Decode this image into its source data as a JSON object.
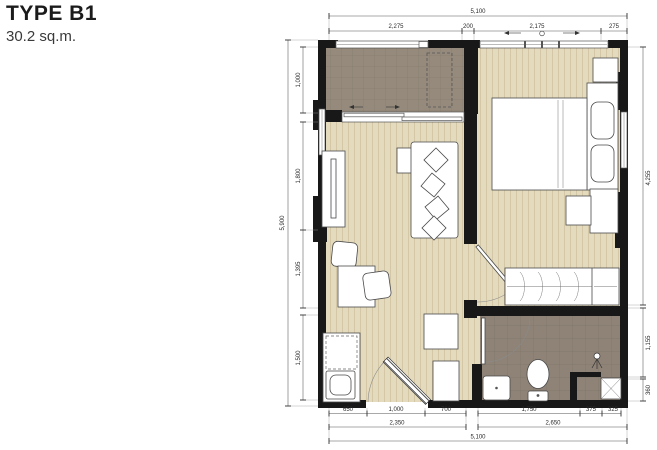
{
  "header": {
    "title": "TYPE B1",
    "area": "30.2 sq.m."
  },
  "dimensions": {
    "top": {
      "overall": "5,100",
      "segments": [
        "2,275",
        "200",
        "2,175",
        "275"
      ]
    },
    "left": {
      "overall": "5,900",
      "segments": [
        "1,000",
        "1,800",
        "1,395",
        "1,500"
      ]
    },
    "right": {
      "segments": [
        "4,255",
        "1,155",
        "360"
      ]
    },
    "bottom": {
      "segments": [
        "650",
        "1,000",
        "700",
        "1,750",
        "375",
        "325"
      ],
      "subtotals": [
        "2,350",
        "2,650"
      ],
      "overall": "5,100"
    }
  },
  "colors": {
    "wall": "#181818",
    "wood_floor": "#e4dabd",
    "wood_stripe": "#d3c7a6",
    "balcony_floor": "#958a7c",
    "balcony_grid": "#877d6e",
    "bath_floor": "#8e8376",
    "bath_grid": "#7f7568",
    "dim_text": "#2b2b2b"
  }
}
